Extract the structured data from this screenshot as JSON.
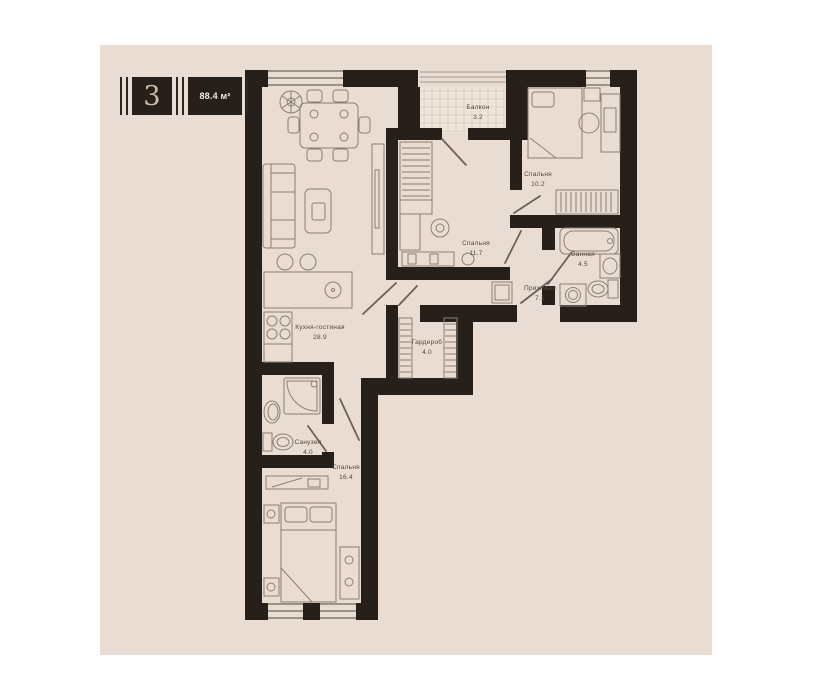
{
  "badge": {
    "number": "3",
    "area": "88.4 м²"
  },
  "rooms": [
    {
      "id": "balcony",
      "name": "Балкон",
      "area": "3.2"
    },
    {
      "id": "bedroom-top",
      "name": "Спальня",
      "area": "10.2"
    },
    {
      "id": "bedroom-middle",
      "name": "Спальня",
      "area": "11.7"
    },
    {
      "id": "bathroom",
      "name": "Ванная",
      "area": "4.5"
    },
    {
      "id": "hallway",
      "name": "Прихожая",
      "area": "7.1"
    },
    {
      "id": "wardrobe",
      "name": "Гардероб",
      "area": "4.0"
    },
    {
      "id": "kitchen-living",
      "name": "Кухня-гостиная",
      "area": "28.9"
    },
    {
      "id": "wc",
      "name": "Санузел",
      "area": "4.0"
    },
    {
      "id": "bedroom-bottom",
      "name": "Спальня",
      "area": "16.4"
    }
  ]
}
